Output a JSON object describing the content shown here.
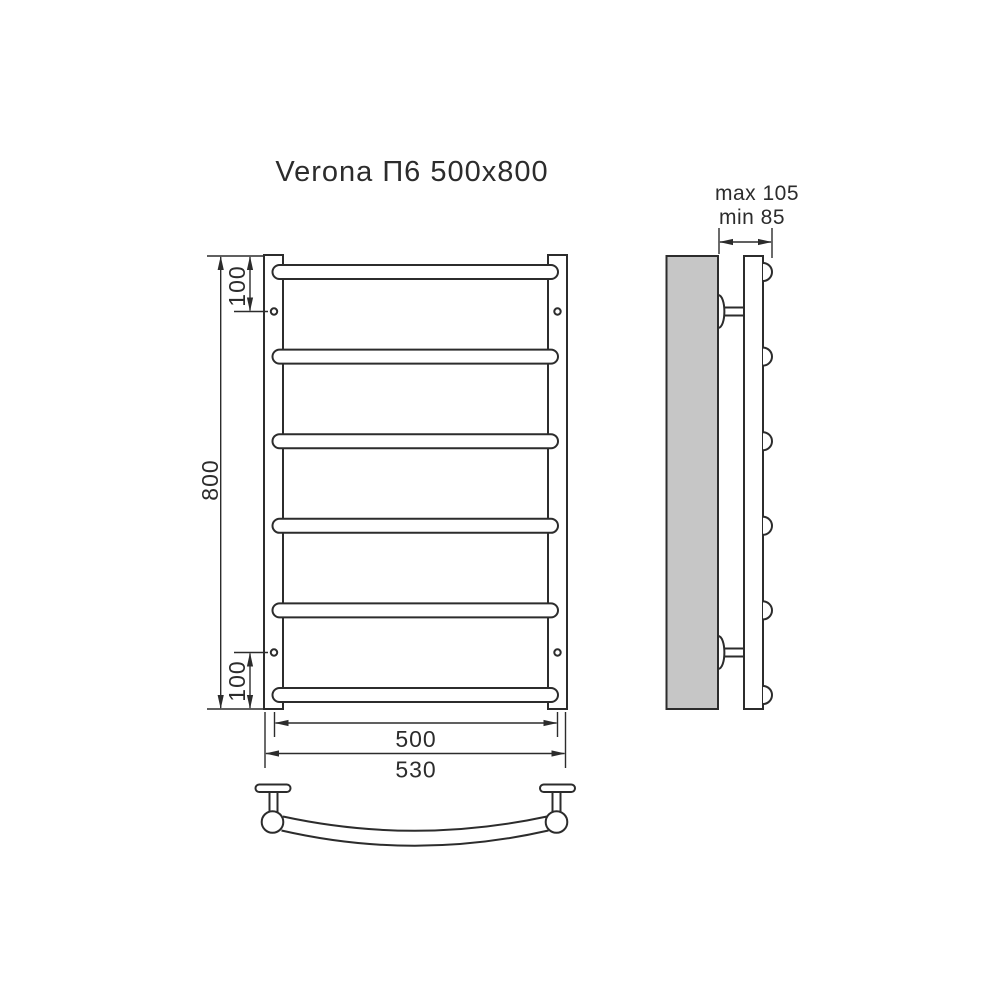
{
  "title": "Verona П6 500x800",
  "colors": {
    "line": "#2c2c2c",
    "wall_fill": "#c6c6c6",
    "background": "#ffffff"
  },
  "front_view": {
    "rung_count": 6,
    "height_label": "800",
    "top_hole_offset_label": "100",
    "bottom_hole_offset_label": "100",
    "rung_width_label": "500",
    "overall_width_label": "530"
  },
  "side_view": {
    "depth_max_label": "max 105",
    "depth_min_label": "min 85"
  }
}
